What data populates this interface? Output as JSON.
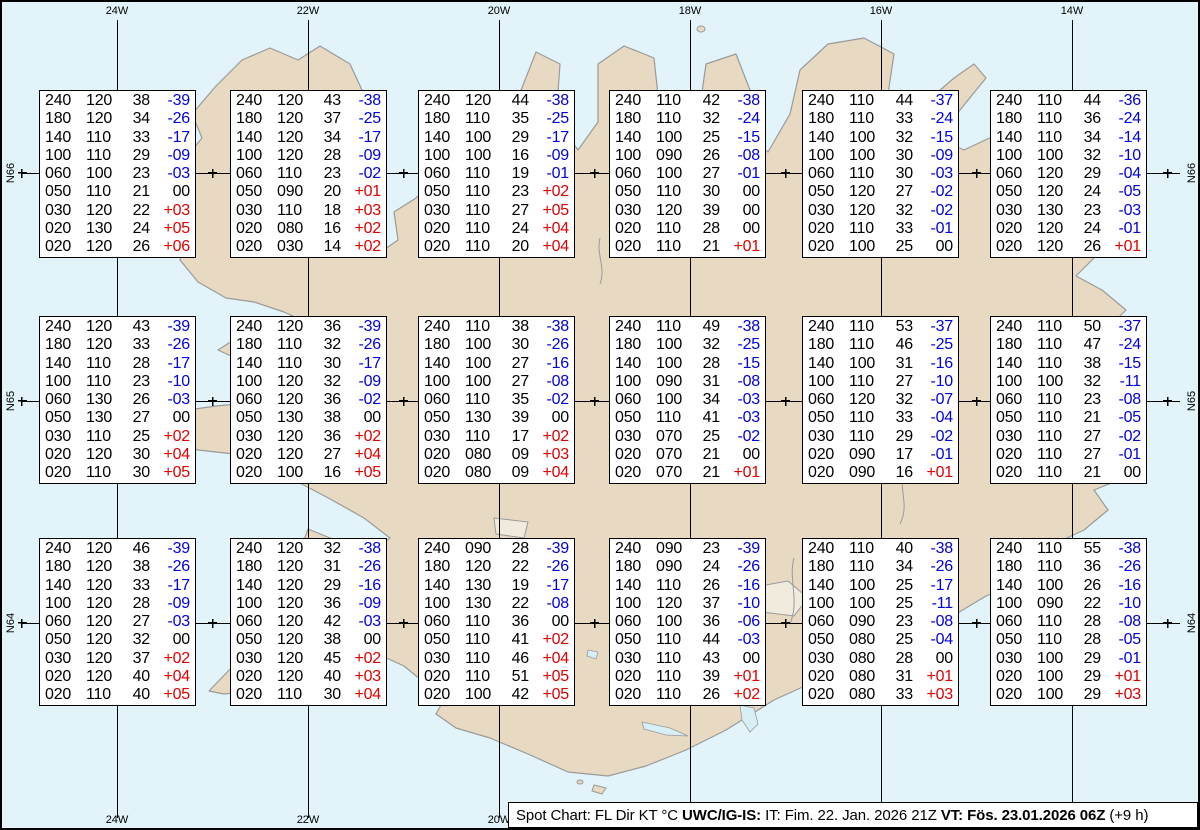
{
  "colors": {
    "ocean": "#e2f4f9",
    "land": "#e8d9c3",
    "coast": "#9a9a9a",
    "grid": "#000000",
    "box_bg": "#ffffff",
    "box_border": "#000000",
    "temp_neg": "#0000e0",
    "temp_pos": "#e00000",
    "lake": "#d8eff6",
    "glacier": "#f0ebdd"
  },
  "graticule": {
    "meridians": [
      {
        "label": "24W",
        "x": 115
      },
      {
        "label": "22W",
        "x": 306
      },
      {
        "label": "20W",
        "x": 497
      },
      {
        "label": "18W",
        "x": 688
      },
      {
        "label": "16W",
        "x": 879
      },
      {
        "label": "14W",
        "x": 1070
      }
    ],
    "parallels": [
      {
        "label": "N66",
        "y": 171
      },
      {
        "label": "N65",
        "y": 399
      },
      {
        "label": "N64",
        "y": 621
      }
    ],
    "tick_xs": [
      20,
      210.5,
      401.5,
      592.5,
      783.5,
      974.5,
      1165.5
    ]
  },
  "columns_meaning": [
    "FL",
    "Dir",
    "KT",
    "°C"
  ],
  "stations": [
    {
      "x": 37,
      "y": 88,
      "rows": [
        [
          "240",
          "120",
          "38",
          "-39"
        ],
        [
          "180",
          "120",
          "34",
          "-26"
        ],
        [
          "140",
          "110",
          "33",
          "-17"
        ],
        [
          "100",
          "110",
          "29",
          "-09"
        ],
        [
          "060",
          "100",
          "23",
          "-03"
        ],
        [
          "050",
          "110",
          "21",
          "00"
        ],
        [
          "030",
          "120",
          "22",
          "+03"
        ],
        [
          "020",
          "130",
          "24",
          "+05"
        ],
        [
          "020",
          "120",
          "26",
          "+06"
        ]
      ]
    },
    {
      "x": 228,
      "y": 88,
      "rows": [
        [
          "240",
          "120",
          "43",
          "-38"
        ],
        [
          "180",
          "120",
          "37",
          "-25"
        ],
        [
          "140",
          "120",
          "34",
          "-17"
        ],
        [
          "100",
          "120",
          "28",
          "-09"
        ],
        [
          "060",
          "110",
          "23",
          "-02"
        ],
        [
          "050",
          "090",
          "20",
          "+01"
        ],
        [
          "030",
          "110",
          "18",
          "+03"
        ],
        [
          "020",
          "080",
          "16",
          "+02"
        ],
        [
          "020",
          "030",
          "14",
          "+02"
        ]
      ]
    },
    {
      "x": 416,
      "y": 88,
      "rows": [
        [
          "240",
          "120",
          "44",
          "-38"
        ],
        [
          "180",
          "110",
          "35",
          "-25"
        ],
        [
          "140",
          "100",
          "29",
          "-17"
        ],
        [
          "100",
          "100",
          "16",
          "-09"
        ],
        [
          "060",
          "110",
          "19",
          "-01"
        ],
        [
          "050",
          "110",
          "23",
          "+02"
        ],
        [
          "030",
          "110",
          "27",
          "+05"
        ],
        [
          "020",
          "110",
          "24",
          "+04"
        ],
        [
          "020",
          "110",
          "20",
          "+04"
        ]
      ]
    },
    {
      "x": 607,
      "y": 88,
      "rows": [
        [
          "240",
          "110",
          "42",
          "-38"
        ],
        [
          "180",
          "110",
          "32",
          "-24"
        ],
        [
          "140",
          "100",
          "25",
          "-15"
        ],
        [
          "100",
          "090",
          "26",
          "-08"
        ],
        [
          "060",
          "100",
          "27",
          "-01"
        ],
        [
          "050",
          "110",
          "30",
          "00"
        ],
        [
          "030",
          "120",
          "39",
          "00"
        ],
        [
          "020",
          "110",
          "28",
          "00"
        ],
        [
          "020",
          "110",
          "21",
          "+01"
        ]
      ]
    },
    {
      "x": 800,
      "y": 88,
      "rows": [
        [
          "240",
          "110",
          "44",
          "-37"
        ],
        [
          "180",
          "110",
          "33",
          "-24"
        ],
        [
          "140",
          "100",
          "32",
          "-15"
        ],
        [
          "100",
          "100",
          "30",
          "-09"
        ],
        [
          "060",
          "110",
          "30",
          "-03"
        ],
        [
          "050",
          "120",
          "27",
          "-02"
        ],
        [
          "030",
          "120",
          "32",
          "-02"
        ],
        [
          "020",
          "110",
          "33",
          "-01"
        ],
        [
          "020",
          "100",
          "25",
          "00"
        ]
      ]
    },
    {
      "x": 988,
      "y": 88,
      "rows": [
        [
          "240",
          "110",
          "44",
          "-36"
        ],
        [
          "180",
          "110",
          "36",
          "-24"
        ],
        [
          "140",
          "110",
          "34",
          "-14"
        ],
        [
          "100",
          "100",
          "32",
          "-10"
        ],
        [
          "060",
          "120",
          "29",
          "-04"
        ],
        [
          "050",
          "120",
          "24",
          "-05"
        ],
        [
          "030",
          "130",
          "23",
          "-03"
        ],
        [
          "020",
          "120",
          "24",
          "-01"
        ],
        [
          "020",
          "120",
          "26",
          "+01"
        ]
      ]
    },
    {
      "x": 37,
      "y": 314,
      "rows": [
        [
          "240",
          "120",
          "43",
          "-39"
        ],
        [
          "180",
          "120",
          "33",
          "-26"
        ],
        [
          "140",
          "110",
          "28",
          "-17"
        ],
        [
          "100",
          "110",
          "23",
          "-10"
        ],
        [
          "060",
          "130",
          "26",
          "-03"
        ],
        [
          "050",
          "130",
          "27",
          "00"
        ],
        [
          "030",
          "110",
          "25",
          "+02"
        ],
        [
          "020",
          "120",
          "30",
          "+04"
        ],
        [
          "020",
          "110",
          "30",
          "+05"
        ]
      ]
    },
    {
      "x": 228,
      "y": 314,
      "rows": [
        [
          "240",
          "120",
          "36",
          "-39"
        ],
        [
          "180",
          "110",
          "32",
          "-26"
        ],
        [
          "140",
          "110",
          "30",
          "-17"
        ],
        [
          "100",
          "120",
          "32",
          "-09"
        ],
        [
          "060",
          "120",
          "36",
          "-02"
        ],
        [
          "050",
          "130",
          "38",
          "00"
        ],
        [
          "030",
          "120",
          "36",
          "+02"
        ],
        [
          "020",
          "120",
          "27",
          "+04"
        ],
        [
          "020",
          "100",
          "16",
          "+05"
        ]
      ]
    },
    {
      "x": 416,
      "y": 314,
      "rows": [
        [
          "240",
          "110",
          "38",
          "-38"
        ],
        [
          "180",
          "100",
          "30",
          "-26"
        ],
        [
          "140",
          "100",
          "27",
          "-16"
        ],
        [
          "100",
          "100",
          "27",
          "-08"
        ],
        [
          "060",
          "110",
          "35",
          "-02"
        ],
        [
          "050",
          "130",
          "39",
          "00"
        ],
        [
          "030",
          "110",
          "17",
          "+02"
        ],
        [
          "020",
          "080",
          "09",
          "+03"
        ],
        [
          "020",
          "080",
          "09",
          "+04"
        ]
      ]
    },
    {
      "x": 607,
      "y": 314,
      "rows": [
        [
          "240",
          "110",
          "49",
          "-38"
        ],
        [
          "180",
          "100",
          "32",
          "-25"
        ],
        [
          "140",
          "100",
          "28",
          "-15"
        ],
        [
          "100",
          "090",
          "31",
          "-08"
        ],
        [
          "060",
          "100",
          "34",
          "-03"
        ],
        [
          "050",
          "110",
          "41",
          "-03"
        ],
        [
          "030",
          "070",
          "25",
          "-02"
        ],
        [
          "020",
          "070",
          "21",
          "00"
        ],
        [
          "020",
          "070",
          "21",
          "+01"
        ]
      ]
    },
    {
      "x": 800,
      "y": 314,
      "rows": [
        [
          "240",
          "110",
          "53",
          "-37"
        ],
        [
          "180",
          "110",
          "46",
          "-25"
        ],
        [
          "140",
          "100",
          "31",
          "-16"
        ],
        [
          "100",
          "110",
          "27",
          "-10"
        ],
        [
          "060",
          "120",
          "32",
          "-07"
        ],
        [
          "050",
          "110",
          "33",
          "-04"
        ],
        [
          "030",
          "110",
          "29",
          "-02"
        ],
        [
          "020",
          "090",
          "17",
          "-01"
        ],
        [
          "020",
          "090",
          "16",
          "+01"
        ]
      ]
    },
    {
      "x": 988,
      "y": 314,
      "rows": [
        [
          "240",
          "110",
          "50",
          "-37"
        ],
        [
          "180",
          "110",
          "47",
          "-24"
        ],
        [
          "140",
          "110",
          "38",
          "-15"
        ],
        [
          "100",
          "100",
          "32",
          "-11"
        ],
        [
          "060",
          "110",
          "23",
          "-08"
        ],
        [
          "050",
          "110",
          "21",
          "-05"
        ],
        [
          "030",
          "110",
          "27",
          "-02"
        ],
        [
          "020",
          "110",
          "27",
          "-01"
        ],
        [
          "020",
          "110",
          "21",
          "00"
        ]
      ]
    },
    {
      "x": 37,
      "y": 536,
      "rows": [
        [
          "240",
          "120",
          "46",
          "-39"
        ],
        [
          "180",
          "120",
          "38",
          "-26"
        ],
        [
          "140",
          "120",
          "33",
          "-17"
        ],
        [
          "100",
          "120",
          "28",
          "-09"
        ],
        [
          "060",
          "120",
          "27",
          "-03"
        ],
        [
          "050",
          "120",
          "32",
          "00"
        ],
        [
          "030",
          "120",
          "37",
          "+02"
        ],
        [
          "020",
          "120",
          "40",
          "+04"
        ],
        [
          "020",
          "110",
          "40",
          "+05"
        ]
      ]
    },
    {
      "x": 228,
      "y": 536,
      "rows": [
        [
          "240",
          "120",
          "32",
          "-38"
        ],
        [
          "180",
          "120",
          "31",
          "-26"
        ],
        [
          "140",
          "120",
          "29",
          "-16"
        ],
        [
          "100",
          "120",
          "36",
          "-09"
        ],
        [
          "060",
          "120",
          "42",
          "-03"
        ],
        [
          "050",
          "120",
          "38",
          "00"
        ],
        [
          "030",
          "120",
          "45",
          "+02"
        ],
        [
          "020",
          "120",
          "40",
          "+03"
        ],
        [
          "020",
          "110",
          "30",
          "+04"
        ]
      ]
    },
    {
      "x": 416,
      "y": 536,
      "rows": [
        [
          "240",
          "090",
          "28",
          "-39"
        ],
        [
          "180",
          "120",
          "22",
          "-26"
        ],
        [
          "140",
          "130",
          "19",
          "-17"
        ],
        [
          "100",
          "130",
          "22",
          "-08"
        ],
        [
          "060",
          "110",
          "36",
          "00"
        ],
        [
          "050",
          "110",
          "41",
          "+02"
        ],
        [
          "030",
          "110",
          "46",
          "+04"
        ],
        [
          "020",
          "110",
          "51",
          "+05"
        ],
        [
          "020",
          "100",
          "42",
          "+05"
        ]
      ]
    },
    {
      "x": 607,
      "y": 536,
      "rows": [
        [
          "240",
          "090",
          "23",
          "-39"
        ],
        [
          "180",
          "090",
          "24",
          "-26"
        ],
        [
          "140",
          "110",
          "26",
          "-16"
        ],
        [
          "100",
          "120",
          "37",
          "-10"
        ],
        [
          "060",
          "100",
          "36",
          "-06"
        ],
        [
          "050",
          "110",
          "44",
          "-03"
        ],
        [
          "030",
          "110",
          "43",
          "00"
        ],
        [
          "020",
          "110",
          "39",
          "+01"
        ],
        [
          "020",
          "110",
          "26",
          "+02"
        ]
      ]
    },
    {
      "x": 800,
      "y": 536,
      "rows": [
        [
          "240",
          "110",
          "40",
          "-38"
        ],
        [
          "180",
          "110",
          "34",
          "-26"
        ],
        [
          "140",
          "100",
          "25",
          "-17"
        ],
        [
          "100",
          "100",
          "25",
          "-11"
        ],
        [
          "060",
          "090",
          "23",
          "-08"
        ],
        [
          "050",
          "080",
          "25",
          "-04"
        ],
        [
          "030",
          "080",
          "28",
          "00"
        ],
        [
          "020",
          "080",
          "31",
          "+01"
        ],
        [
          "020",
          "080",
          "33",
          "+03"
        ]
      ]
    },
    {
      "x": 988,
      "y": 536,
      "rows": [
        [
          "240",
          "110",
          "55",
          "-38"
        ],
        [
          "180",
          "110",
          "36",
          "-26"
        ],
        [
          "140",
          "100",
          "26",
          "-16"
        ],
        [
          "100",
          "090",
          "22",
          "-10"
        ],
        [
          "060",
          "110",
          "28",
          "-08"
        ],
        [
          "050",
          "110",
          "28",
          "-05"
        ],
        [
          "030",
          "100",
          "29",
          "-01"
        ],
        [
          "020",
          "100",
          "29",
          "+01"
        ],
        [
          "020",
          "100",
          "29",
          "+03"
        ]
      ]
    }
  ],
  "status_bar": {
    "segments": [
      {
        "text": "Spot Chart: FL Dir KT °C ",
        "bold": false
      },
      {
        "text": "UWC/IG-IS:",
        "bold": true
      },
      {
        "text": " IT: Fim. 22. Jan. 2026 21Z ",
        "bold": false
      },
      {
        "text": "VT: Fös. 23.01.2026 06Z",
        "bold": true
      },
      {
        "text": " (+9 h)",
        "bold": false
      }
    ]
  }
}
